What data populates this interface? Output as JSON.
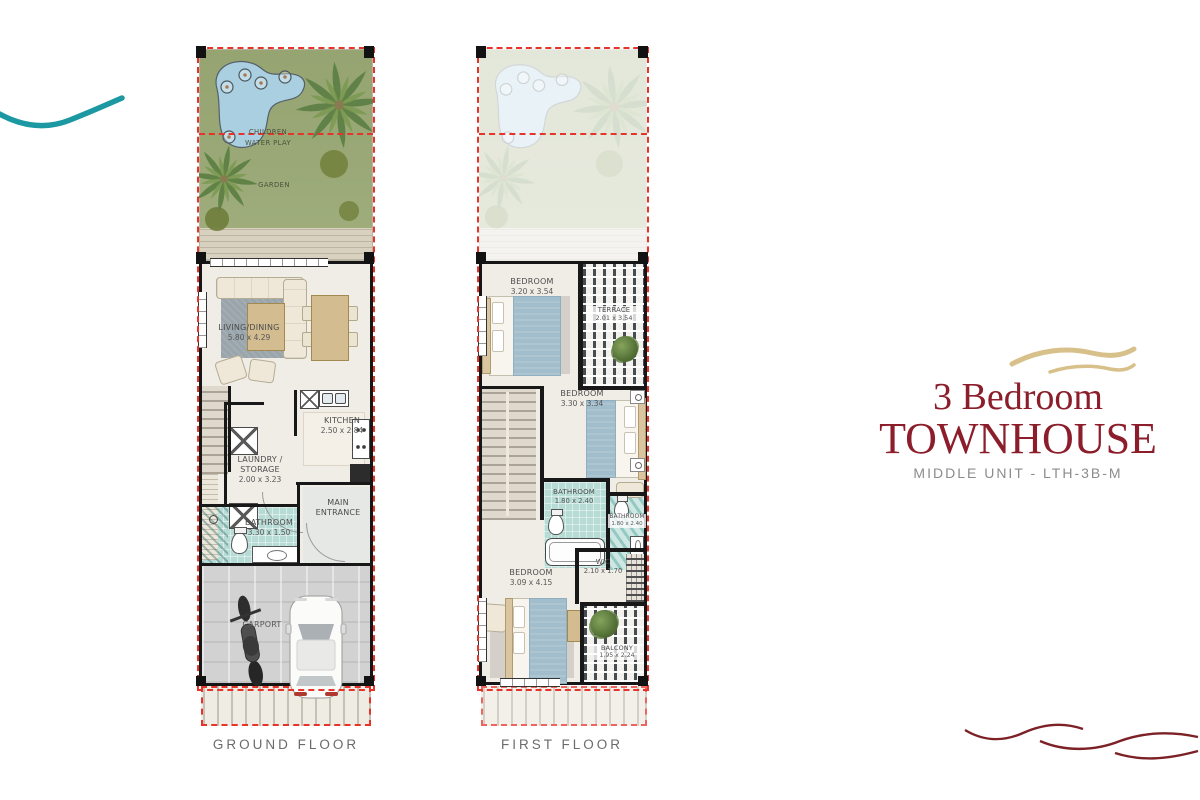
{
  "branding": {
    "title_line1": "3 Bedroom",
    "title_line2": "TOWNHOUSE",
    "subtitle": "MIDDLE UNIT - LTH-3B-M"
  },
  "ground_floor": {
    "caption": "GROUND FLOOR",
    "garden": {
      "water_play": "CHILDREN\nWATER PLAY",
      "garden": "GARDEN"
    },
    "rooms": {
      "living_dining": {
        "name": "LIVING/DINING",
        "dims": "5.80 x 4.29"
      },
      "kitchen": {
        "name": "KITCHEN",
        "dims": "2.50 x 2.84"
      },
      "laundry_storage": {
        "name": "LAUNDRY /\nSTORAGE",
        "dims": "2.00 x 3.23"
      },
      "main_entrance": {
        "name": "MAIN\nENTRANCE"
      },
      "bathroom": {
        "name": "BATHROOM",
        "dims": "3.30 x 1.50"
      },
      "carport": {
        "name": "CARPORT"
      }
    }
  },
  "first_floor": {
    "caption": "FIRST FLOOR",
    "rooms": {
      "bedroom_1": {
        "name": "BEDROOM",
        "dims": "3.20 x 3.54"
      },
      "terrace": {
        "name": "TERRACE",
        "dims": "2.01 x 3.54"
      },
      "bedroom_2": {
        "name": "BEDROOM",
        "dims": "3.30 x 3.34"
      },
      "bathroom_1": {
        "name": "BATHROOM",
        "dims": "1.80 x 2.40"
      },
      "bathroom_2": {
        "name": "BATHROOM",
        "dims": "1.80 x 2.40"
      },
      "wic": {
        "name": "WIC",
        "dims": "2.10 x 1.70"
      },
      "bedroom_3": {
        "name": "BEDROOM",
        "dims": "3.09 x 4.15"
      },
      "balcony": {
        "name": "BALCONY",
        "dims": "1.95 x 2.24"
      }
    }
  },
  "colors": {
    "accent_red": "#8c1e2b",
    "subtitle_gray": "#8c8c8c",
    "boundary_red": "#e6342b",
    "teal_wave": "#1b98a2",
    "gold_wave": "#d8c08b",
    "garden_green": "#98a673",
    "pool_blue": "#a9cfe0",
    "bath_teal": "#b7dbd5",
    "wall_black": "#161616"
  }
}
